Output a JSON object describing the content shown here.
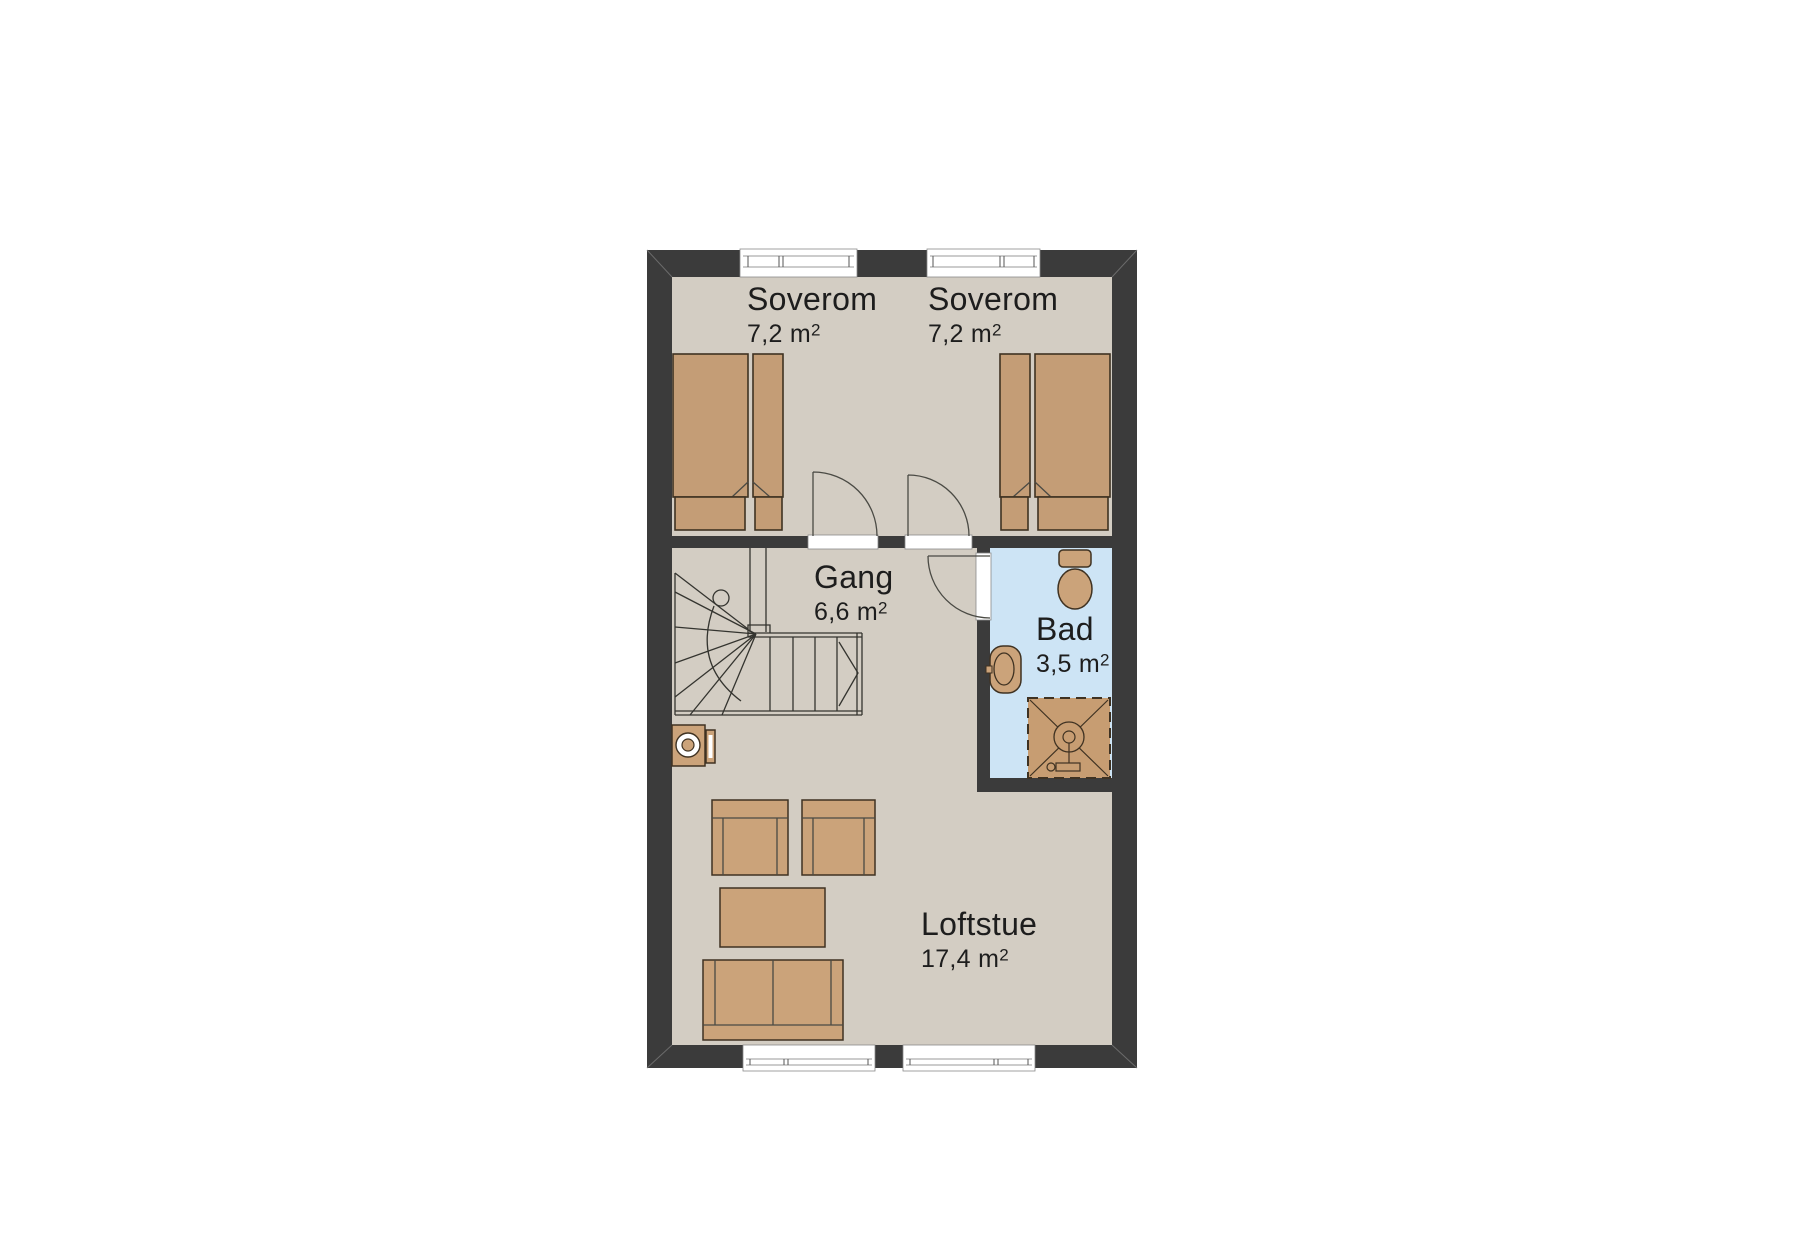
{
  "floorplan": {
    "rooms": [
      {
        "id": "soverom-1",
        "name": "Soverom",
        "area": "7,2 m",
        "area_sup": "2"
      },
      {
        "id": "soverom-2",
        "name": "Soverom",
        "area": "7,2 m",
        "area_sup": "2"
      },
      {
        "id": "gang",
        "name": "Gang",
        "area": "6,6 m",
        "area_sup": "2"
      },
      {
        "id": "bad",
        "name": "Bad",
        "area": "3,5 m",
        "area_sup": "2"
      },
      {
        "id": "loftstue",
        "name": "Loftstue",
        "area": "17,4 m",
        "area_sup": "2"
      }
    ],
    "fixtures": [
      "double-bed-left",
      "double-bed-right",
      "winder-staircase",
      "stair-direction-arrow",
      "washing-machine",
      "armchair",
      "armchair",
      "coffee-table",
      "sofa",
      "toilet",
      "washbasin",
      "shower-cabin",
      "window",
      "window",
      "window",
      "window",
      "door-swing",
      "door-swing",
      "door-swing"
    ],
    "colors": {
      "wall": "#3b3b3b",
      "floor": "#d3cdc3",
      "bath": "#cde4f5",
      "tan": "#cba37a",
      "bed": "#c49d76",
      "shower": "#c79d72",
      "outline": "#3f3222",
      "line": "#4a4a44",
      "text": "#1d1d1d",
      "white": "#ffffff"
    }
  }
}
